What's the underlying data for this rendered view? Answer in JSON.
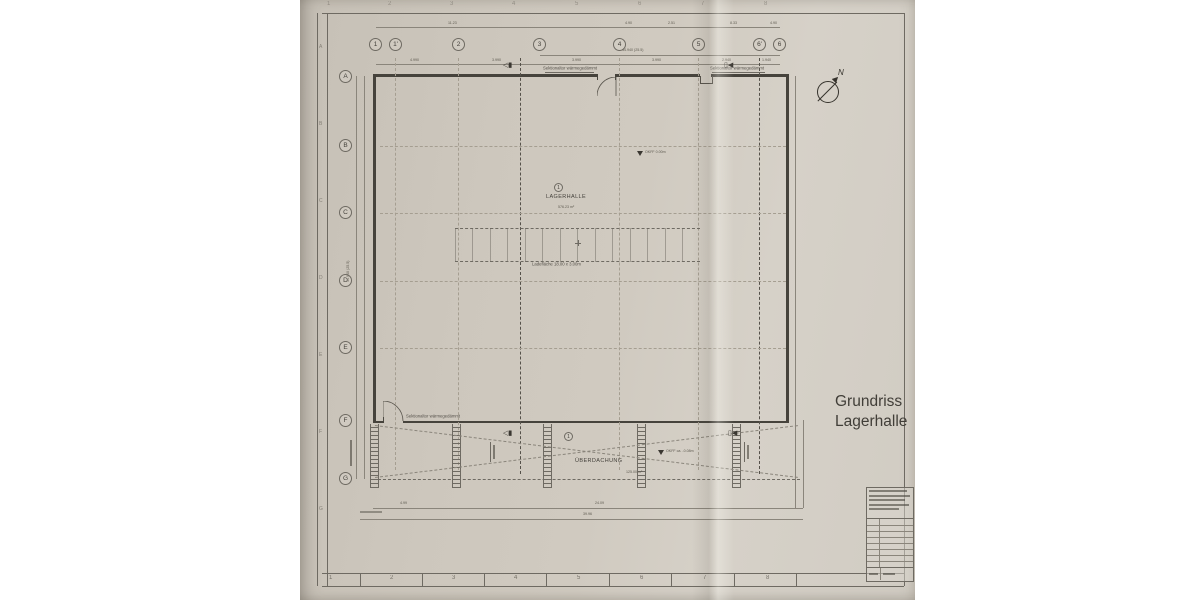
{
  "annotation": {
    "line1": "Grundriss",
    "line2": "Lagerhalle"
  },
  "compass": {
    "label": "N"
  },
  "axes": {
    "top": [
      "1",
      "1'",
      "2",
      "3",
      "4",
      "5",
      "6'",
      "6"
    ],
    "left": [
      "A",
      "B",
      "C",
      "D",
      "E",
      "F",
      "G"
    ]
  },
  "frame": {
    "top": [
      "1",
      "2",
      "3",
      "4",
      "5",
      "6",
      "7",
      "8"
    ],
    "bottom": [
      "1",
      "2",
      "3",
      "4",
      "5",
      "6",
      "7",
      "8"
    ],
    "left": [
      "A",
      "B",
      "C",
      "D",
      "E",
      "F",
      "G"
    ]
  },
  "room": {
    "index": "1",
    "name": "LAGERHALLE",
    "area": "576.23 m²",
    "level": "OKFF 0.00m"
  },
  "canopy": {
    "index": "1",
    "name": "ÜBERDACHUNG",
    "area": "125.00 m²",
    "level": "OKFF ca. -0.08m"
  },
  "labels": {
    "sectional_door": "Sektionaltor wärmegedämmt",
    "loading_strip": "Ladefläche 18.00 x 3.00m"
  },
  "dims": {
    "top_total": "11.23",
    "top_a": "4.90",
    "top_b": "2.51",
    "top_c": "8.33",
    "top_d": "4.90",
    "mid_total": "44.940 (25.5)",
    "seg_1": "4.990",
    "seg_2": "3.990",
    "seg_3": "3.990",
    "seg_4": "3.990",
    "seg_5": "2.940",
    "seg_6": "1.940",
    "left_total": "44.940 (25.5)",
    "bottom_a": "4.99",
    "bottom_b": "24.09",
    "bottom_total": "39.96"
  },
  "colors": {
    "paper": "#cdc7bd",
    "line": "#6e6a62",
    "wall": "#46433c"
  }
}
